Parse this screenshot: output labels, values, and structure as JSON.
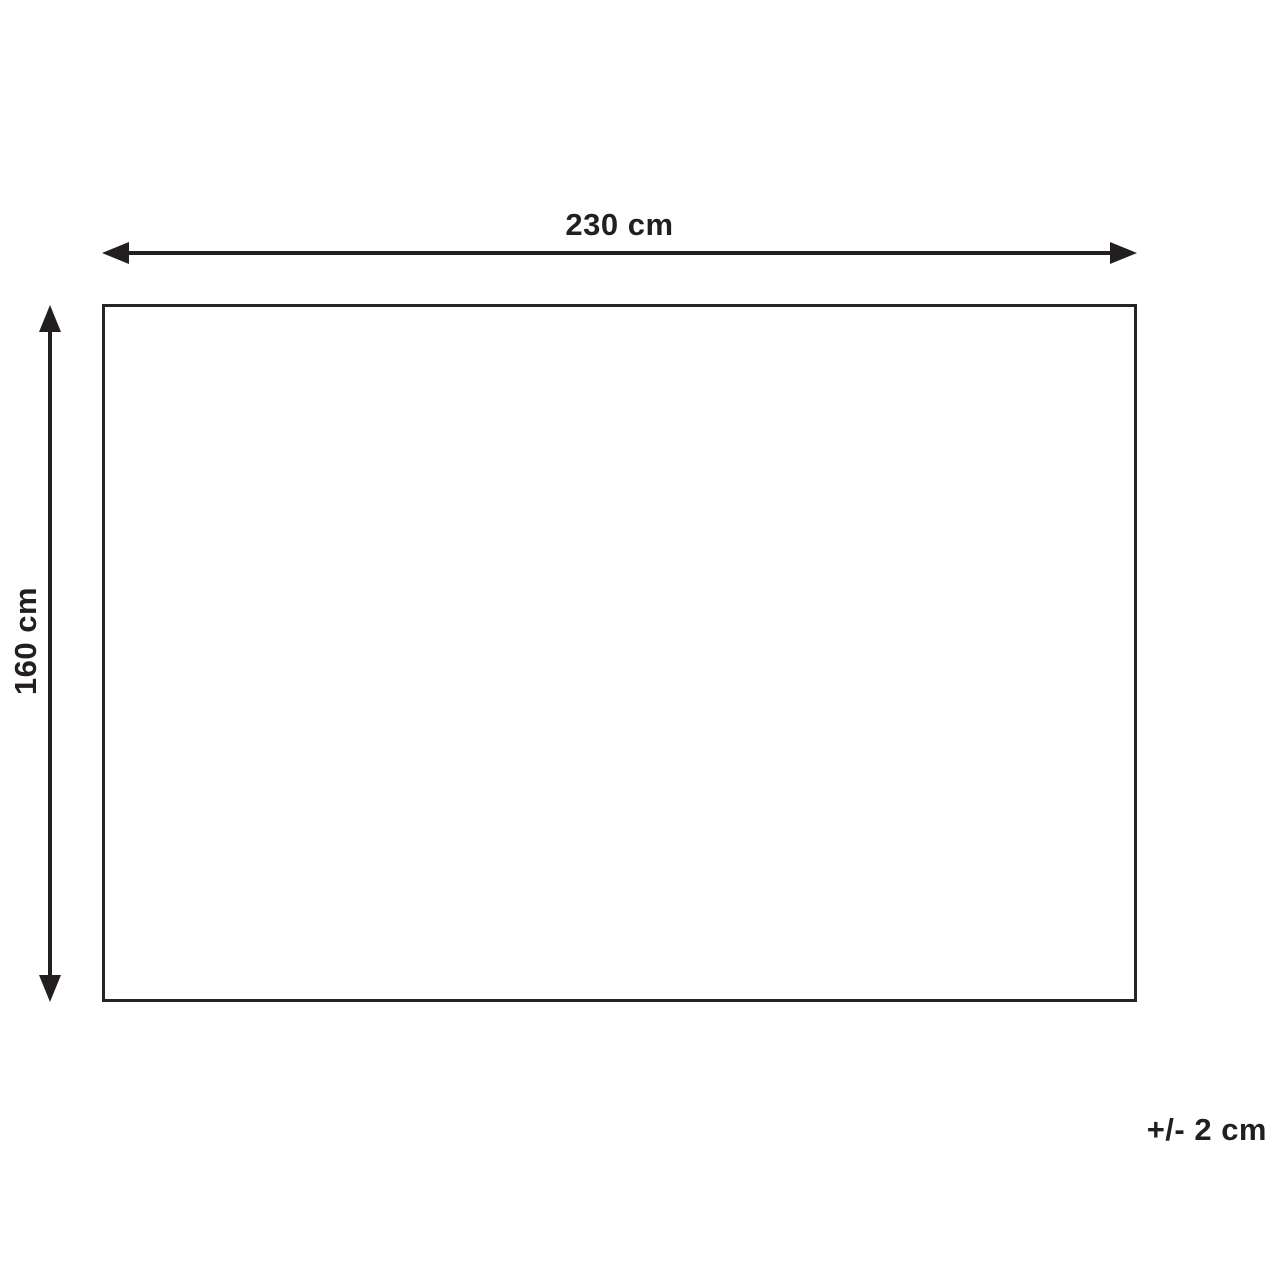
{
  "figure": {
    "width_label": "230 cm",
    "height_label": "160 cm",
    "tolerance_label": "+/- 2 cm"
  },
  "colors": {
    "line": "#231f20",
    "background": "#ffffff"
  }
}
